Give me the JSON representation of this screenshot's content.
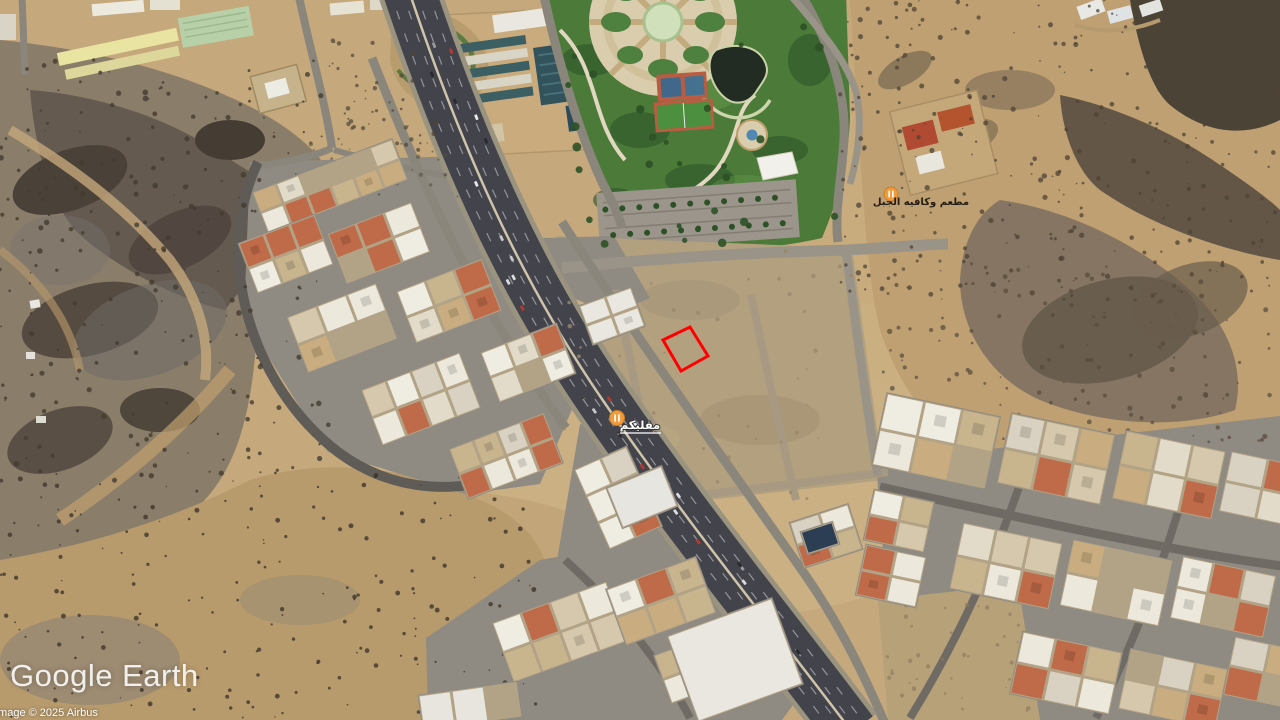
{
  "app": {
    "watermark": "Google Earth",
    "copyright": "Image © 2025 Airbus"
  },
  "map": {
    "view": "satellite",
    "pois": [
      {
        "label": "مقليكم",
        "category": "restaurant",
        "pin_color": "#f09c3c",
        "label_style": "white-underlined"
      },
      {
        "label": "مطعم وكافيه الجبل",
        "category": "restaurant",
        "pin_color": "#f09c3c",
        "label_style": "dark"
      }
    ],
    "plot_outline": {
      "color": "#ff0000",
      "shape": "rotated-rectangle"
    }
  },
  "palette": {
    "sand": "#c5a87c",
    "rock": "#55493c",
    "asphalt": "#43434b",
    "street": "#908b82",
    "park": "#4b7a39",
    "pond": "#222c23",
    "court": "#b85c42",
    "pitch": "#4c8f3f",
    "building_light": "#ece8dc",
    "pin": "#f09c3c",
    "plot": "#ff0000"
  }
}
